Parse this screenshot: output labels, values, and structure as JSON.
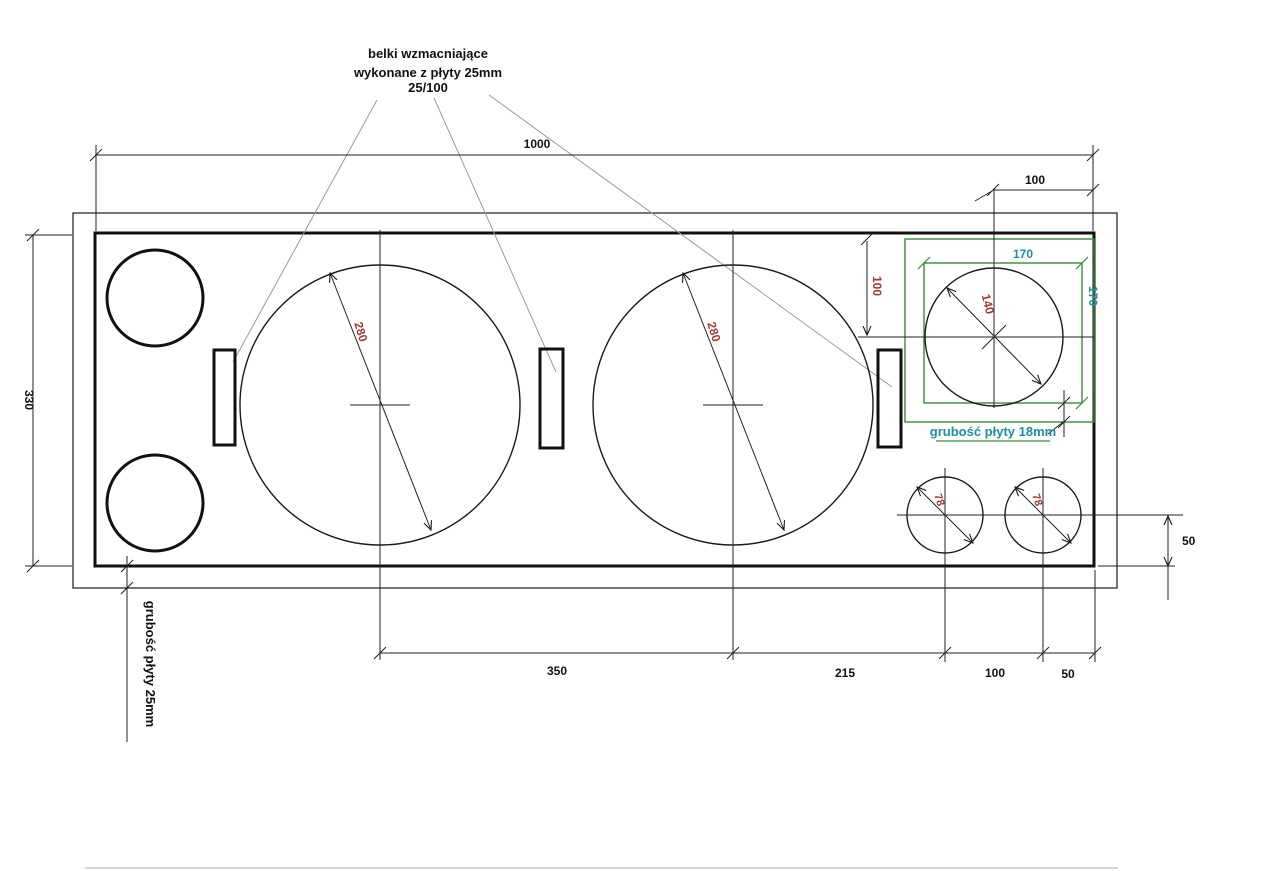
{
  "note_top": {
    "line1": "belki wzmacniające",
    "line2": "wykonane z płyty 25mm",
    "line3": "25/100"
  },
  "dimensions": {
    "total_width": "1000",
    "offset_top_right": "100",
    "panel_height": "330",
    "spacing_woofers": "350",
    "spacing_woofer_to_port": "215",
    "spacing_ports": "100",
    "offset_port_right": "50",
    "offset_port_bottom": "50",
    "tweeter_box_offset_vertical": "100",
    "tweeter_box_width": "170",
    "tweeter_box_height": "170",
    "woofer_left_diameter": "280",
    "woofer_right_diameter": "280",
    "tweeter_diameter": "140",
    "port_right_1_diameter": "78",
    "port_right_2_diameter": "78"
  },
  "annotations": {
    "board_thickness_18": "grubość płyty 18mm",
    "board_thickness_25": "grubość płyty 25mm"
  },
  "colors": {
    "line": "#1a1a1a",
    "leader": "#9a9a9a",
    "dim_red": "#9e3a3a",
    "teal": "#1b91a5",
    "green": "#3a8a3a"
  }
}
